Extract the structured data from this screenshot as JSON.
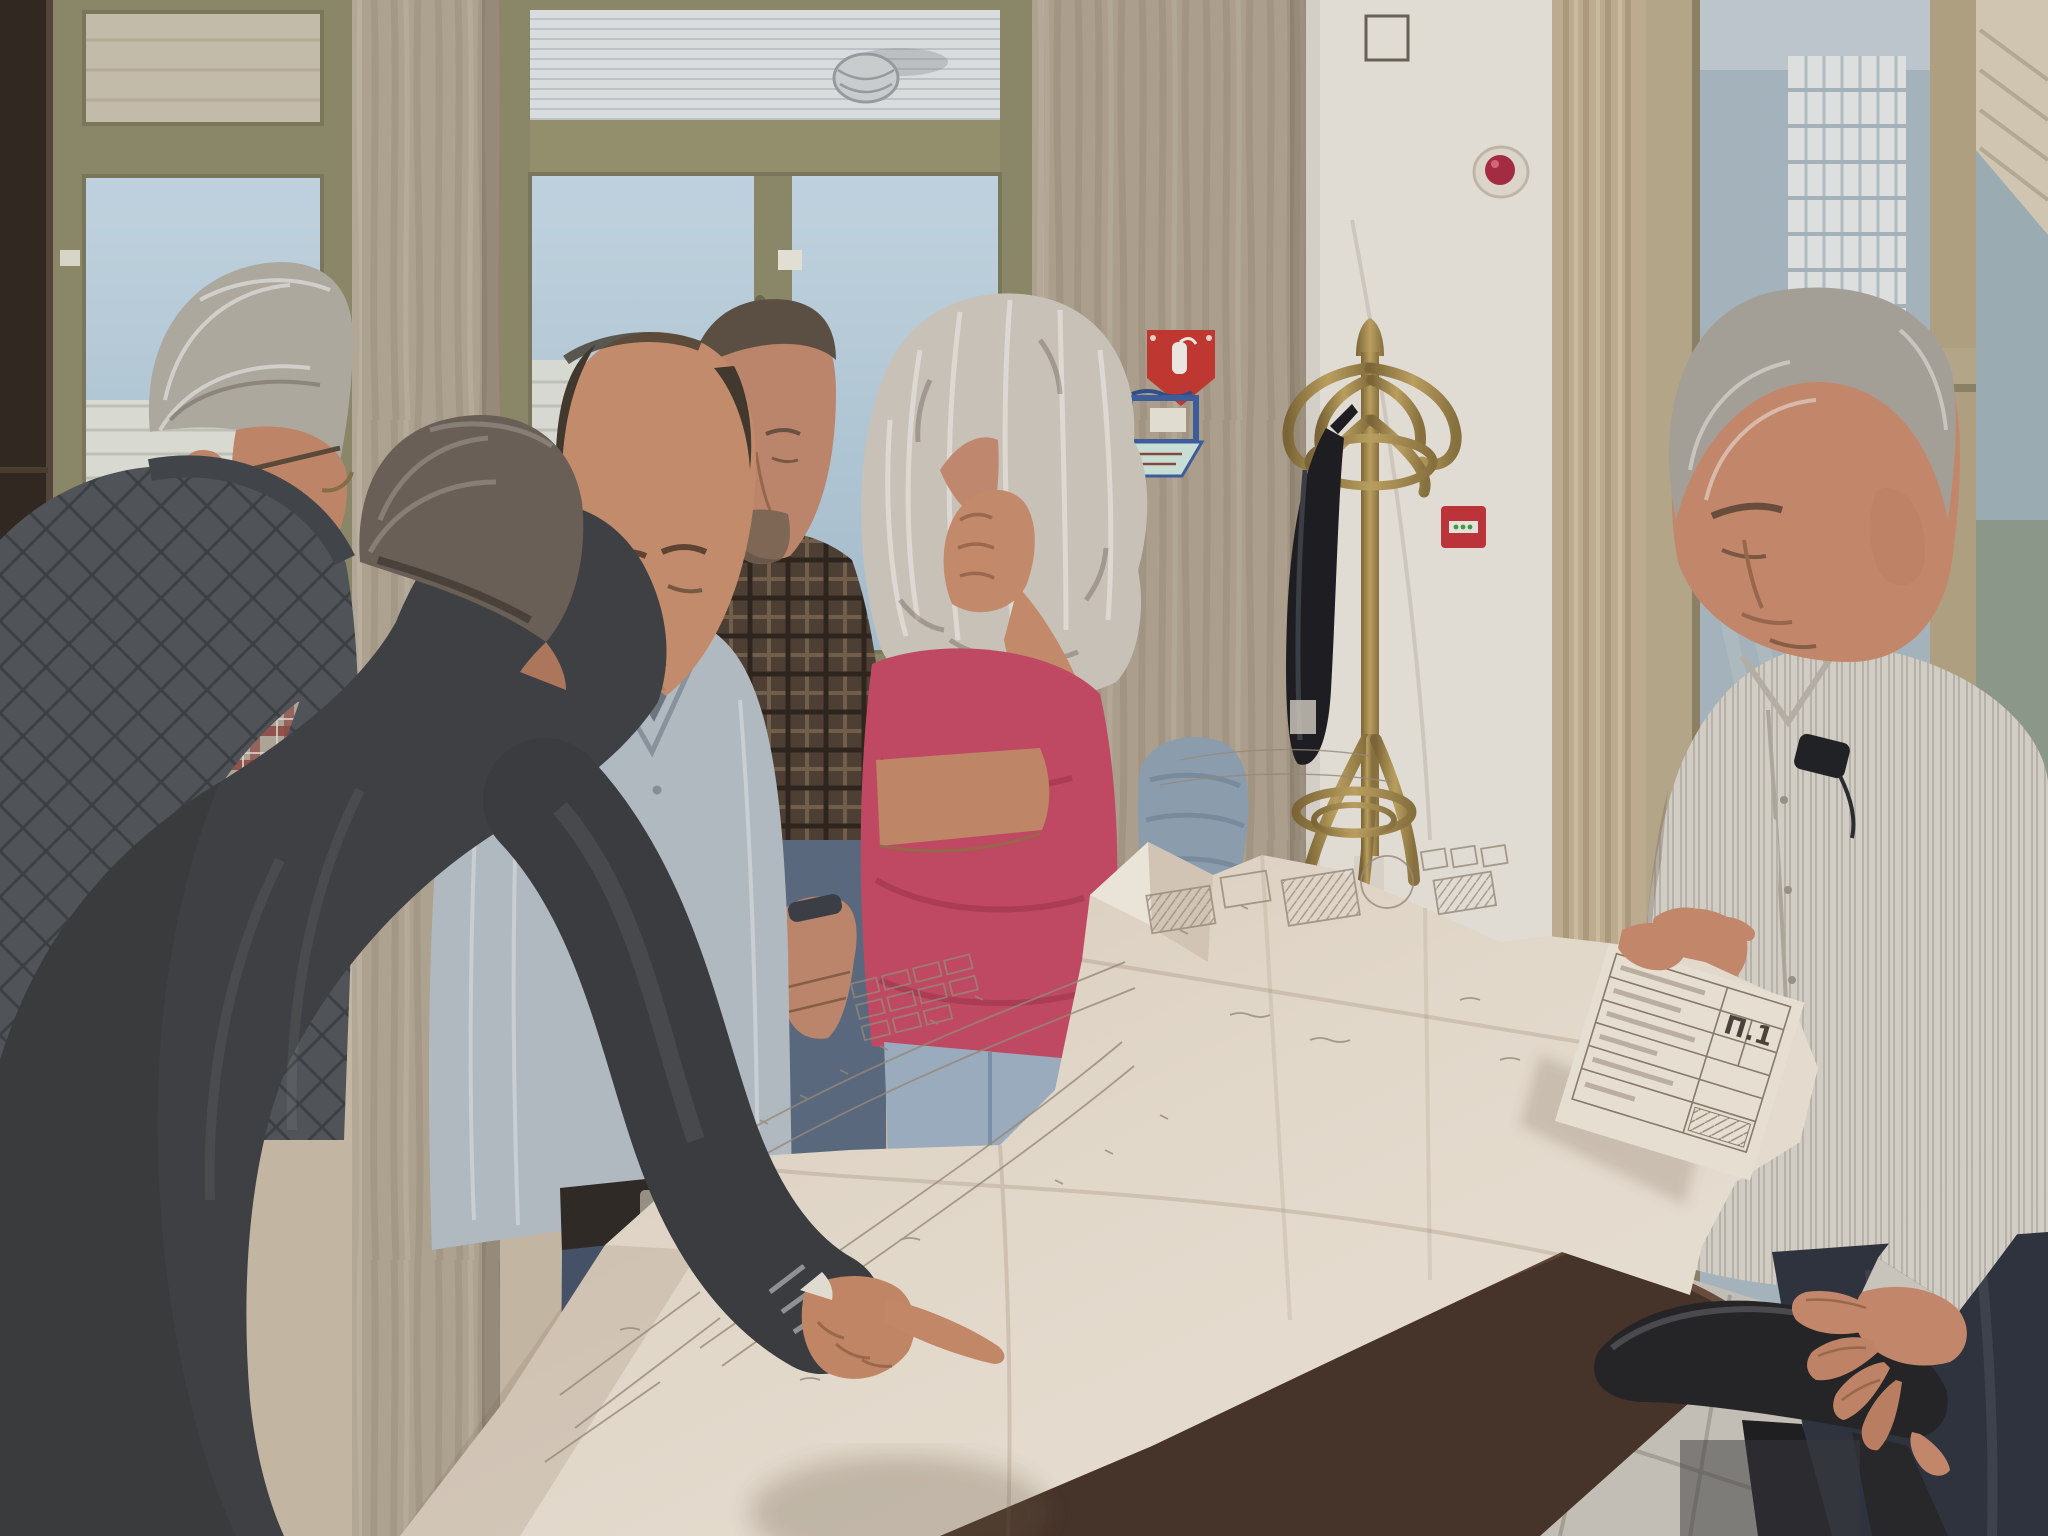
{
  "drawing": {
    "sheet_label": "Π.1"
  },
  "palette": {
    "wall": "#c9bdaa",
    "pillar": "#b3a896",
    "white_wall": "#e9e5dd",
    "window_frame": "#8e8b6c",
    "sky_glass": "#b9cfdf",
    "door_frame": "#b8ab8e",
    "curtain": "#c3b296",
    "paper": "#e6dccd",
    "paper_lines": "#9a8d7d",
    "table": "#46332a",
    "floor_tile": "#c9c6bd",
    "chair": "#232327",
    "coat_rack_brass": "#a5894b",
    "fire_sign_red": "#c43832",
    "alarm_dome_red": "#a82c44",
    "call_point_red": "#c0343c",
    "skin": "#c78a68",
    "left_man_vest": "#50555b",
    "suit": "#3e4145",
    "center_shirt": "#b7c0c9",
    "goatee_shirt": "#4e4036",
    "woman_top": "#c64a66",
    "woman_jeans": "#9db1c4",
    "woman_hair": "#cfc9c0",
    "right_shirt": "#d8d5ce",
    "right_trousers": "#2d3340",
    "center_jeans": "#45536b",
    "plant_green": "#4a5c38",
    "cabinet": "#2f2721"
  }
}
